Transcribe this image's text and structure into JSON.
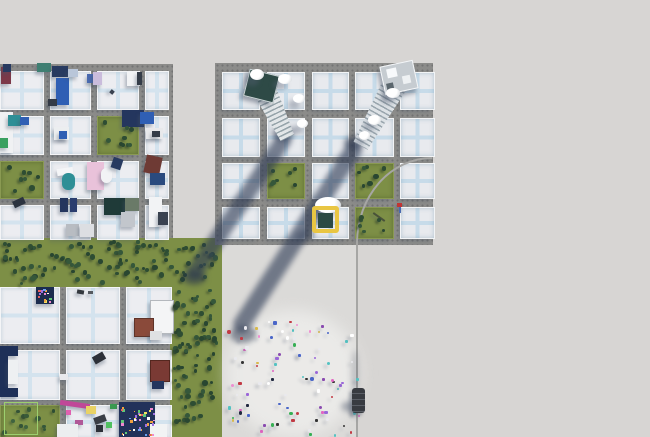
{
  "scene": {
    "w": 650,
    "h": 437,
    "colors": {
      "ground": "#d7d5d3",
      "road": "#8c8c8a",
      "grass": "#7d8f46",
      "plaza": "#dbdad8",
      "shadow": "rgba(47,60,86,0.62)",
      "selection_yellow": "#e9c643",
      "selection_fill": "#2c4a44",
      "path_line": "#a6a6a4"
    },
    "greens": [
      {
        "x": 0,
        "y": 238,
        "w": 222,
        "h": 49
      },
      {
        "x": 170,
        "y": 287,
        "w": 52,
        "h": 150
      }
    ],
    "plaza": {
      "x": 222,
      "y": 243,
      "w": 135,
      "h": 194
    },
    "crowd_glow": {
      "x": 226,
      "y": 310,
      "w": 134,
      "h": 127
    },
    "vline": {
      "x": 356,
      "y": 243,
      "w": 2,
      "h": 194
    },
    "curve": {
      "x": 356,
      "y": 157,
      "rx": 76,
      "ry": 86
    },
    "cities": [
      {
        "id": "left-district",
        "rect": {
          "x": 0,
          "y": 64,
          "w": 173,
          "h": 174
        },
        "cls": "paved2",
        "blocks": [
          {
            "x": 0,
            "y": 71,
            "w": 42,
            "h": 37
          },
          {
            "x": 50,
            "y": 71,
            "w": 39,
            "h": 37
          },
          {
            "x": 97,
            "y": 71,
            "w": 40,
            "h": 37
          },
          {
            "x": 145,
            "y": 71,
            "w": 22,
            "h": 37
          },
          {
            "x": 0,
            "y": 116,
            "w": 42,
            "h": 37
          },
          {
            "x": 50,
            "y": 116,
            "w": 39,
            "h": 37
          },
          {
            "x": 97,
            "y": 116,
            "w": 40,
            "h": 37,
            "g": 1
          },
          {
            "x": 145,
            "y": 116,
            "w": 22,
            "h": 37
          },
          {
            "x": 0,
            "y": 161,
            "w": 42,
            "h": 36,
            "g": 1
          },
          {
            "x": 50,
            "y": 161,
            "w": 39,
            "h": 36
          },
          {
            "x": 97,
            "y": 161,
            "w": 40,
            "h": 36
          },
          {
            "x": 145,
            "y": 161,
            "w": 22,
            "h": 36
          },
          {
            "x": 0,
            "y": 205,
            "w": 42,
            "h": 33
          },
          {
            "x": 50,
            "y": 205,
            "w": 39,
            "h": 33
          },
          {
            "x": 97,
            "y": 205,
            "w": 40,
            "h": 33
          },
          {
            "x": 145,
            "y": 205,
            "w": 22,
            "h": 33
          }
        ]
      },
      {
        "id": "new-district",
        "rect": {
          "x": 215,
          "y": 63,
          "w": 218,
          "h": 182
        },
        "cls": "paved",
        "blocks": [
          {
            "x": 222,
            "y": 72,
            "w": 36,
            "h": 36
          },
          {
            "x": 267,
            "y": 72,
            "w": 36,
            "h": 36
          },
          {
            "x": 312,
            "y": 72,
            "w": 35,
            "h": 36
          },
          {
            "x": 355,
            "y": 72,
            "w": 37,
            "h": 36
          },
          {
            "x": 400,
            "y": 72,
            "w": 33,
            "h": 36
          },
          {
            "x": 222,
            "y": 118,
            "w": 36,
            "h": 37
          },
          {
            "x": 267,
            "y": 118,
            "w": 36,
            "h": 37
          },
          {
            "x": 312,
            "y": 118,
            "w": 35,
            "h": 37
          },
          {
            "x": 355,
            "y": 118,
            "w": 37,
            "h": 37
          },
          {
            "x": 400,
            "y": 118,
            "w": 33,
            "h": 37
          },
          {
            "x": 222,
            "y": 163,
            "w": 36,
            "h": 34
          },
          {
            "x": 267,
            "y": 163,
            "w": 36,
            "h": 34,
            "g": 1
          },
          {
            "x": 312,
            "y": 163,
            "w": 35,
            "h": 34
          },
          {
            "x": 355,
            "y": 163,
            "w": 37,
            "h": 34,
            "g": 1
          },
          {
            "x": 400,
            "y": 163,
            "w": 33,
            "h": 34
          },
          {
            "x": 222,
            "y": 207,
            "w": 36,
            "h": 30
          },
          {
            "x": 267,
            "y": 207,
            "w": 36,
            "h": 30
          },
          {
            "x": 312,
            "y": 207,
            "w": 35,
            "h": 30
          },
          {
            "x": 355,
            "y": 207,
            "w": 37,
            "h": 30,
            "g": 1
          },
          {
            "x": 400,
            "y": 207,
            "w": 33,
            "h": 30
          }
        ]
      },
      {
        "id": "south-district",
        "rect": {
          "x": 0,
          "y": 287,
          "w": 170,
          "h": 150
        },
        "cls": "paved2",
        "blocks": [
          {
            "x": 0,
            "y": 287,
            "w": 58,
            "h": 55
          },
          {
            "x": 66,
            "y": 287,
            "w": 52,
            "h": 55
          },
          {
            "x": 126,
            "y": 287,
            "w": 44,
            "h": 55
          },
          {
            "x": 0,
            "y": 350,
            "w": 58,
            "h": 48
          },
          {
            "x": 66,
            "y": 350,
            "w": 52,
            "h": 48
          },
          {
            "x": 126,
            "y": 350,
            "w": 44,
            "h": 48
          },
          {
            "x": 0,
            "y": 405,
            "w": 58,
            "h": 32,
            "g": 1
          },
          {
            "x": 66,
            "y": 405,
            "w": 52,
            "h": 32
          },
          {
            "x": 126,
            "y": 405,
            "w": 44,
            "h": 32
          }
        ]
      }
    ],
    "features": [
      {
        "x": 1,
        "y": 67,
        "w": 10,
        "h": 17,
        "c": "#7c3848"
      },
      {
        "x": 3,
        "y": 64,
        "w": 8,
        "h": 8,
        "c": "#273a60"
      },
      {
        "x": 37,
        "y": 63,
        "w": 14,
        "h": 9,
        "c": "#3f7f72"
      },
      {
        "x": 52,
        "y": 66,
        "w": 16,
        "h": 11,
        "c": "#273a60"
      },
      {
        "x": 56,
        "y": 78,
        "w": 13,
        "h": 27,
        "c": "#2f5fb4"
      },
      {
        "x": 68,
        "y": 69,
        "w": 10,
        "h": 8,
        "c": "#b9c6d9"
      },
      {
        "x": 48,
        "y": 99,
        "w": 9,
        "h": 7,
        "c": "#333a46"
      },
      {
        "x": 87,
        "y": 74,
        "w": 9,
        "h": 9,
        "c": "#4a6ab0"
      },
      {
        "x": 93,
        "y": 72,
        "w": 9,
        "h": 13,
        "c": "#cabcdc"
      },
      {
        "x": 127,
        "y": 71,
        "w": 13,
        "h": 15,
        "c": "#f2f3f5"
      },
      {
        "x": 137,
        "y": 72,
        "w": 5,
        "h": 13,
        "c": "#343c48"
      },
      {
        "x": 110,
        "y": 90,
        "w": 4,
        "h": 4,
        "c": "#3a4250",
        "rt": 40
      },
      {
        "x": 0,
        "y": 112,
        "w": 13,
        "h": 41,
        "c": "#f0f1f3"
      },
      {
        "x": 8,
        "y": 115,
        "w": 13,
        "h": 11,
        "c": "#2e8f96"
      },
      {
        "x": 20,
        "y": 117,
        "w": 9,
        "h": 8,
        "c": "#2f5fb4"
      },
      {
        "x": 0,
        "y": 138,
        "w": 8,
        "h": 10,
        "c": "#3aa060"
      },
      {
        "x": 122,
        "y": 110,
        "w": 22,
        "h": 17,
        "c": "#24365e"
      },
      {
        "x": 140,
        "y": 112,
        "w": 14,
        "h": 12,
        "c": "#2f5fb4"
      },
      {
        "x": 146,
        "y": 128,
        "w": 17,
        "h": 11,
        "c": "#e8e9eb"
      },
      {
        "x": 152,
        "y": 131,
        "w": 8,
        "h": 6,
        "c": "#343c48"
      },
      {
        "x": 54,
        "y": 127,
        "w": 15,
        "h": 13,
        "c": "#eceef0"
      },
      {
        "x": 59,
        "y": 131,
        "w": 8,
        "h": 8,
        "c": "#2f5fb4"
      },
      {
        "x": 57,
        "y": 168,
        "w": 16,
        "h": 7,
        "c": "#f4f5f7",
        "rt": -8
      },
      {
        "x": 62,
        "y": 173,
        "w": 13,
        "h": 17,
        "c": "#2e8f96",
        "r": 6
      },
      {
        "x": 87,
        "y": 162,
        "w": 17,
        "h": 28,
        "c": "#e9c2da"
      },
      {
        "x": 101,
        "y": 168,
        "w": 11,
        "h": 15,
        "c": "#f2f3f5",
        "r": 8
      },
      {
        "x": 112,
        "y": 158,
        "w": 10,
        "h": 11,
        "c": "#273a60",
        "rt": 18
      },
      {
        "x": 145,
        "y": 156,
        "w": 16,
        "h": 18,
        "c": "#6e3a34",
        "rt": 12
      },
      {
        "x": 150,
        "y": 173,
        "w": 15,
        "h": 12,
        "c": "#2a4a7e"
      },
      {
        "x": 13,
        "y": 199,
        "w": 12,
        "h": 7,
        "c": "#2c3440",
        "rt": -25
      },
      {
        "x": 60,
        "y": 198,
        "w": 8,
        "h": 14,
        "c": "#24365e"
      },
      {
        "x": 70,
        "y": 198,
        "w": 7,
        "h": 14,
        "c": "#2a3d6e"
      },
      {
        "x": 66,
        "y": 224,
        "w": 13,
        "h": 12,
        "c": "#b8bcc2"
      },
      {
        "x": 80,
        "y": 224,
        "w": 14,
        "h": 13,
        "c": "#dcdee2"
      },
      {
        "x": 104,
        "y": 198,
        "w": 21,
        "h": 17,
        "c": "#1f3a38"
      },
      {
        "x": 125,
        "y": 198,
        "w": 14,
        "h": 13,
        "c": "#6a7a68"
      },
      {
        "x": 121,
        "y": 212,
        "w": 14,
        "h": 15,
        "c": "#c2c6cc"
      },
      {
        "x": 149,
        "y": 197,
        "w": 13,
        "h": 30,
        "c": "#f2f3f5"
      },
      {
        "x": 158,
        "y": 212,
        "w": 10,
        "h": 13,
        "c": "#3a4250"
      },
      {
        "x": 397,
        "y": 203,
        "w": 5,
        "h": 4,
        "c": "#c23434"
      },
      {
        "x": 399,
        "y": 207,
        "w": 2,
        "h": 6,
        "c": "#4a6ab0"
      },
      {
        "x": 372,
        "y": 216,
        "w": 14,
        "h": 2,
        "c": "#49523a",
        "rt": 35
      },
      {
        "x": 36,
        "y": 287,
        "w": 18,
        "h": 17,
        "c": "#1c2c4e"
      },
      {
        "x": 77,
        "y": 290,
        "w": 7,
        "h": 4,
        "c": "#33373d",
        "rt": 10
      },
      {
        "x": 88,
        "y": 291,
        "w": 5,
        "h": 3,
        "c": "#565a60"
      },
      {
        "x": 150,
        "y": 300,
        "w": 22,
        "h": 32,
        "c": "#f4f5f6",
        "b": "#b4b8bd"
      },
      {
        "x": 134,
        "y": 318,
        "w": 18,
        "h": 17,
        "c": "#8a4a3a",
        "b": "#5f3328"
      },
      {
        "x": 150,
        "y": 331,
        "w": 12,
        "h": 9,
        "c": "#dfe1e3"
      },
      {
        "x": 0,
        "y": 346,
        "w": 18,
        "h": 10,
        "c": "#1e3058"
      },
      {
        "x": 0,
        "y": 354,
        "w": 8,
        "h": 34,
        "c": "#1e3058"
      },
      {
        "x": 0,
        "y": 388,
        "w": 18,
        "h": 9,
        "c": "#1e3058"
      },
      {
        "x": 8,
        "y": 360,
        "w": 10,
        "h": 24,
        "c": "#eef0f2"
      },
      {
        "x": 93,
        "y": 354,
        "w": 12,
        "h": 8,
        "c": "#2c3038",
        "rt": -30
      },
      {
        "x": 60,
        "y": 374,
        "w": 8,
        "h": 6,
        "c": "#e8e9ec"
      },
      {
        "x": 150,
        "y": 360,
        "w": 18,
        "h": 20,
        "c": "#7a3a34",
        "b": "#54271f"
      },
      {
        "x": 152,
        "y": 381,
        "w": 12,
        "h": 8,
        "c": "#24365e"
      },
      {
        "x": 60,
        "y": 402,
        "w": 30,
        "h": 5,
        "c": "#c04898",
        "rt": 8
      },
      {
        "x": 66,
        "y": 410,
        "w": 5,
        "h": 5,
        "c": "#e060b0"
      },
      {
        "x": 86,
        "y": 406,
        "w": 10,
        "h": 8,
        "c": "#e9d264"
      },
      {
        "x": 94,
        "y": 416,
        "w": 12,
        "h": 7,
        "c": "#3a3e46",
        "rt": -20
      },
      {
        "x": 75,
        "y": 420,
        "w": 8,
        "h": 5,
        "c": "#b05898"
      },
      {
        "x": 57,
        "y": 424,
        "w": 21,
        "h": 13,
        "c": "#eceef0"
      },
      {
        "x": 96,
        "y": 425,
        "w": 7,
        "h": 7,
        "c": "#2c3038"
      },
      {
        "x": 110,
        "y": 404,
        "w": 7,
        "h": 5,
        "c": "#3a9a50"
      },
      {
        "x": 106,
        "y": 422,
        "w": 6,
        "h": 6,
        "c": "#50c060"
      },
      {
        "x": 119,
        "y": 402,
        "w": 36,
        "h": 35,
        "c": "#22325a"
      },
      {
        "x": 150,
        "y": 424,
        "w": 17,
        "h": 13,
        "c": "#f2f3f4"
      }
    ],
    "tree_regions": [
      {
        "x": 2,
        "y": 240,
        "w": 218,
        "h": 45,
        "n": 105,
        "seed": 11
      },
      {
        "x": 172,
        "y": 289,
        "w": 48,
        "h": 146,
        "n": 78,
        "seed": 22
      },
      {
        "x": 99,
        "y": 118,
        "w": 36,
        "h": 33,
        "n": 9,
        "seed": 33
      },
      {
        "x": 2,
        "y": 163,
        "w": 38,
        "h": 32,
        "n": 8,
        "seed": 44
      },
      {
        "x": 269,
        "y": 165,
        "w": 32,
        "h": 30,
        "n": 7,
        "seed": 55
      },
      {
        "x": 357,
        "y": 165,
        "w": 33,
        "h": 30,
        "n": 7,
        "seed": 66
      },
      {
        "x": 357,
        "y": 209,
        "w": 33,
        "h": 26,
        "n": 6,
        "seed": 77
      },
      {
        "x": 2,
        "y": 407,
        "w": 54,
        "h": 28,
        "n": 12,
        "seed": 88
      }
    ],
    "tree_palette": [
      "#2e4d33",
      "#35573a",
      "#294631"
    ],
    "bands": [
      {
        "x1": 287,
        "y1": 134,
        "x2": 190,
        "y2": 279,
        "w": 16
      },
      {
        "x1": 358,
        "y1": 143,
        "x2": 237,
        "y2": 332,
        "w": 17
      }
    ],
    "blobs": [
      {
        "x": 272,
        "y": 126,
        "w": 22,
        "h": 15,
        "c": "rgba(44,56,80,0.5)"
      },
      {
        "x": 344,
        "y": 136,
        "w": 19,
        "h": 13,
        "c": "rgba(44,56,80,0.5)"
      },
      {
        "x": 182,
        "y": 270,
        "w": 24,
        "h": 15,
        "c": "rgba(40,52,74,0.55)"
      },
      {
        "x": 230,
        "y": 326,
        "w": 26,
        "h": 17,
        "c": "rgba(44,56,80,0.5)"
      },
      {
        "x": 295,
        "y": 230,
        "w": 19,
        "h": 12,
        "c": "rgba(50,62,86,0.42)"
      },
      {
        "x": 341,
        "y": 401,
        "w": 21,
        "h": 11,
        "c": "rgba(50,62,86,0.38)"
      },
      {
        "x": 351,
        "y": 350,
        "w": 8,
        "h": 46,
        "c": "rgba(90,98,112,0.28)"
      }
    ],
    "crowd": {
      "x": 226,
      "y": 318,
      "w": 132,
      "h": 116,
      "n": 88,
      "seed": 99,
      "palette": [
        "#ffffff",
        "#20283f",
        "#e264c2",
        "#8a4bb0",
        "#36b054",
        "#c23a44",
        "#4a66c8",
        "#ef8fd2",
        "#343434",
        "#e9e9ee",
        "#54c2c2",
        "#9a66d8",
        "#d8b94a"
      ]
    },
    "confetti": [
      {
        "x": 121,
        "y": 404,
        "w": 32,
        "h": 31,
        "n": 42,
        "seed": 7
      },
      {
        "x": 37,
        "y": 288,
        "w": 16,
        "h": 15,
        "n": 12,
        "seed": 8
      }
    ],
    "confetti_palette": [
      "#e86060",
      "#f0e060",
      "#60c878",
      "#6aa0f0",
      "#f088d0",
      "#ffffff",
      "#f0a040",
      "#a070e0"
    ],
    "towers": [
      {
        "roof": {
          "x": 246,
          "y": 72,
          "w": 29,
          "h": 26,
          "rt": 14,
          "c": "#2e4a46",
          "edge": "#cdd6d8"
        },
        "body": {
          "x1": 262,
          "y1": 86,
          "x2": 287,
          "y2": 138,
          "w1": 24,
          "w2": 15,
          "a": "#e2e6e8",
          "b": "#96a4aa"
        }
      },
      {
        "roof": {
          "x": 382,
          "y": 63,
          "w": 32,
          "h": 27,
          "rt": -12,
          "c": "#c6ccd1",
          "edge": "#f4f6f8",
          "panels": [
            {
              "x": 5,
              "y": 3,
              "w": 10,
              "h": 9,
              "c": "#f7f9fb"
            },
            {
              "x": 19,
              "y": 13,
              "w": 8,
              "h": 8,
              "c": "#eef1f3"
            },
            {
              "x": 2,
              "y": 17,
              "w": 7,
              "h": 8,
              "c": "#5b666d"
            }
          ]
        },
        "body": {
          "x1": 397,
          "y1": 80,
          "x2": 360,
          "y2": 146,
          "w1": 26,
          "w2": 16,
          "a": "#dde2e6",
          "b": "#9aa6ae"
        }
      }
    ],
    "clouds": [
      {
        "x": 250,
        "y": 69,
        "w": 14,
        "h": 11
      },
      {
        "x": 278,
        "y": 74,
        "w": 14,
        "h": 10
      },
      {
        "x": 293,
        "y": 94,
        "w": 12,
        "h": 9
      },
      {
        "x": 297,
        "y": 119,
        "w": 11,
        "h": 9
      },
      {
        "x": 386,
        "y": 88,
        "w": 14,
        "h": 10
      },
      {
        "x": 368,
        "y": 115,
        "w": 13,
        "h": 10
      },
      {
        "x": 359,
        "y": 131,
        "w": 11,
        "h": 9
      },
      {
        "x": 315,
        "y": 197,
        "w": 26,
        "h": 16
      }
    ],
    "selection": {
      "x": 312,
      "y": 206,
      "w": 27,
      "h": 27,
      "bw": 4,
      "inner": {
        "x": 318,
        "y": 213,
        "w": 15,
        "h": 15
      }
    },
    "vehicle": {
      "x": 352,
      "y": 388,
      "w": 13,
      "h": 25,
      "c": "#383b41",
      "stripe": "#5a5e66"
    },
    "cube_preview": {
      "x": 4,
      "y": 402,
      "w": 34,
      "h": 33,
      "b": "#9ccf6f"
    }
  }
}
